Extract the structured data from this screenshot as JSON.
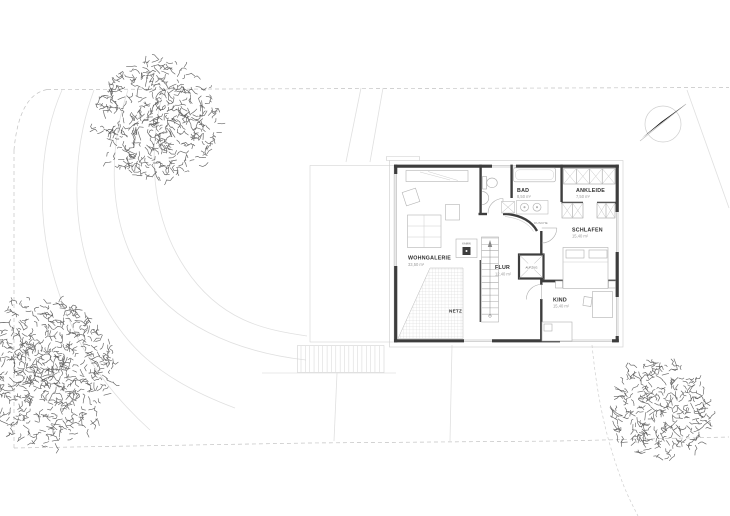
{
  "plan": {
    "rooms": {
      "wohngalerie": {
        "name": "WOHNGALERIE",
        "area": "33,50 m²"
      },
      "flur": {
        "name": "FLUR",
        "area": "12,40 m²"
      },
      "bad": {
        "name": "BAD",
        "area": "8,50 m²"
      },
      "ankleide": {
        "name": "ANKLEIDE",
        "area": "7,50 m²"
      },
      "schlafen": {
        "name": "SCHLAFEN",
        "area": "15,40 m²"
      },
      "kind": {
        "name": "KIND",
        "area": "15,40 m²"
      },
      "netz": {
        "name": "NETZ"
      },
      "kamin": {
        "name": "KAMIN"
      },
      "aufzug": {
        "name": "AUFZUG"
      },
      "dusche": {
        "name": "DUSCHE"
      }
    },
    "colors": {
      "wall": "#3d3d3d",
      "thin_line": "#c8c8c8",
      "furniture": "#b3b3b3",
      "label": "#2f2f2f",
      "area_text": "#9b9b9b",
      "tree": "#4f4f4f"
    }
  }
}
